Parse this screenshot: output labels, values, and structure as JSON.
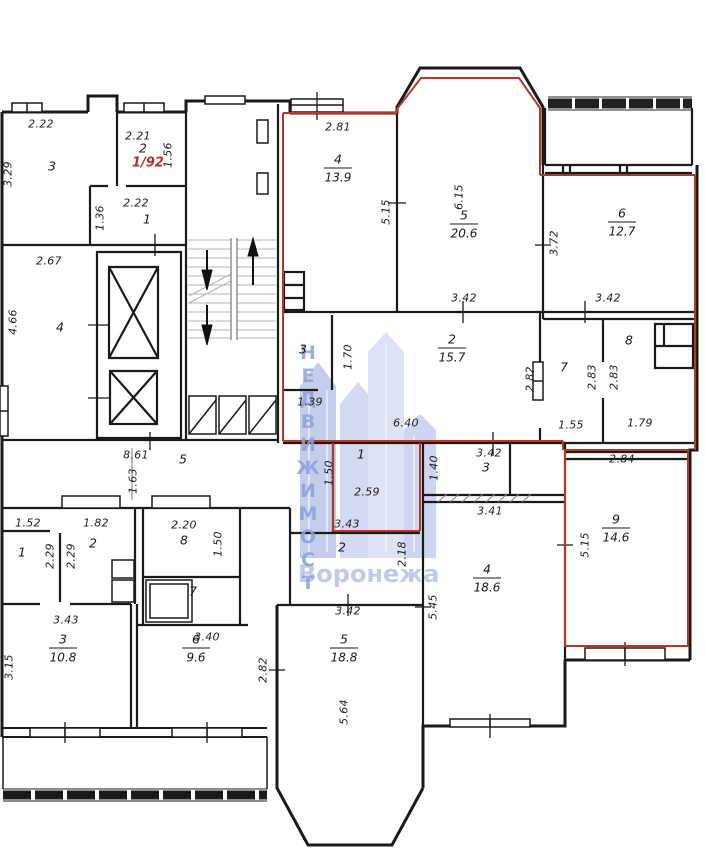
{
  "plan": {
    "flat_label": {
      "text": "1/92",
      "x": 148,
      "y": 163,
      "color": "#b03227"
    },
    "watermark": {
      "vertical_text": "НЕДВИЖИМОСТ",
      "bottom_text": "Воронежа",
      "color": "#8fa0d8"
    },
    "colors": {
      "wall": "#1a1a1a",
      "highlight": "#b03a27",
      "stairs": "#b5b5b5"
    },
    "room_labels": [
      {
        "num": "4",
        "area": "13.9",
        "x": 338,
        "y": 168
      },
      {
        "num": "5",
        "area": "20.6",
        "x": 464,
        "y": 224
      },
      {
        "num": "6",
        "area": "12.7",
        "x": 622,
        "y": 222
      },
      {
        "num": "2",
        "area": "15.7",
        "x": 452,
        "y": 348
      },
      {
        "num": "9",
        "area": "14.6",
        "x": 616,
        "y": 528
      },
      {
        "num": "4",
        "area": "18.6",
        "x": 487,
        "y": 578
      },
      {
        "num": "5",
        "area": "18.8",
        "x": 344,
        "y": 648
      },
      {
        "num": "3",
        "area": "10.8",
        "x": 63,
        "y": 648
      },
      {
        "num": "6",
        "area": "9.6",
        "x": 196,
        "y": 648
      }
    ],
    "room_numbers": [
      {
        "t": "3",
        "x": 52,
        "y": 166
      },
      {
        "t": "2",
        "x": 143,
        "y": 148
      },
      {
        "t": "1",
        "x": 147,
        "y": 219
      },
      {
        "t": "4",
        "x": 60,
        "y": 327
      },
      {
        "t": "3",
        "x": 303,
        "y": 349
      },
      {
        "t": "7",
        "x": 564,
        "y": 367
      },
      {
        "t": "8",
        "x": 629,
        "y": 340
      },
      {
        "t": "1",
        "x": 361,
        "y": 454
      },
      {
        "t": "3",
        "x": 486,
        "y": 467
      },
      {
        "t": "2",
        "x": 342,
        "y": 547
      },
      {
        "t": "1",
        "x": 22,
        "y": 552
      },
      {
        "t": "2",
        "x": 93,
        "y": 543
      },
      {
        "t": "8",
        "x": 184,
        "y": 540
      },
      {
        "t": "7",
        "x": 193,
        "y": 591
      },
      {
        "t": "5",
        "x": 183,
        "y": 459
      }
    ],
    "dimensions": [
      {
        "t": "2.22",
        "x": 41,
        "y": 124,
        "r": 0
      },
      {
        "t": "2.21",
        "x": 138,
        "y": 136,
        "r": 0
      },
      {
        "t": "2.22",
        "x": 136,
        "y": 203,
        "r": 0
      },
      {
        "t": "2.67",
        "x": 49,
        "y": 261,
        "r": 0
      },
      {
        "t": "2.81",
        "x": 338,
        "y": 127,
        "r": 0
      },
      {
        "t": "3.42",
        "x": 464,
        "y": 298,
        "r": 0
      },
      {
        "t": "3.42",
        "x": 608,
        "y": 298,
        "r": 0
      },
      {
        "t": "1.39",
        "x": 310,
        "y": 402,
        "r": 0
      },
      {
        "t": "6.40",
        "x": 406,
        "y": 423,
        "r": 0
      },
      {
        "t": "1.55",
        "x": 571,
        "y": 425,
        "r": 0
      },
      {
        "t": "1.79",
        "x": 640,
        "y": 423,
        "r": 0
      },
      {
        "t": "2.84",
        "x": 622,
        "y": 459,
        "r": 0
      },
      {
        "t": "3.42",
        "x": 489,
        "y": 453,
        "r": 0
      },
      {
        "t": "3.41",
        "x": 490,
        "y": 511,
        "r": 0
      },
      {
        "t": "8.61",
        "x": 136,
        "y": 455,
        "r": 0
      },
      {
        "t": "1.52",
        "x": 28,
        "y": 523,
        "r": 0
      },
      {
        "t": "1.82",
        "x": 96,
        "y": 523,
        "r": 0
      },
      {
        "t": "2.20",
        "x": 184,
        "y": 525,
        "r": 0
      },
      {
        "t": "2.59",
        "x": 367,
        "y": 492,
        "r": 0
      },
      {
        "t": "3.43",
        "x": 347,
        "y": 524,
        "r": 0
      },
      {
        "t": "3.43",
        "x": 66,
        "y": 620,
        "r": 0
      },
      {
        "t": "3.40",
        "x": 207,
        "y": 637,
        "r": 0
      },
      {
        "t": "3.42",
        "x": 348,
        "y": 611,
        "r": 0
      },
      {
        "t": "3.29",
        "x": 8,
        "y": 174,
        "r": -90
      },
      {
        "t": "1.56",
        "x": 168,
        "y": 155,
        "r": -90
      },
      {
        "t": "1.36",
        "x": 100,
        "y": 218,
        "r": -90
      },
      {
        "t": "4.66",
        "x": 13,
        "y": 322,
        "r": -90
      },
      {
        "t": "5.15",
        "x": 386,
        "y": 212,
        "r": -90
      },
      {
        "t": "6.15",
        "x": 459,
        "y": 197,
        "r": -90
      },
      {
        "t": "3.72",
        "x": 554,
        "y": 243,
        "r": -90
      },
      {
        "t": "1.70",
        "x": 348,
        "y": 357,
        "r": -90
      },
      {
        "t": "2.82",
        "x": 530,
        "y": 379,
        "r": -90
      },
      {
        "t": "2.83",
        "x": 592,
        "y": 377,
        "r": -90
      },
      {
        "t": "2.83",
        "x": 614,
        "y": 377,
        "r": -90
      },
      {
        "t": "1.63",
        "x": 133,
        "y": 481,
        "r": -90
      },
      {
        "t": "2.29",
        "x": 50,
        "y": 556,
        "r": -90
      },
      {
        "t": "2.29",
        "x": 71,
        "y": 556,
        "r": -90
      },
      {
        "t": "1.50",
        "x": 218,
        "y": 544,
        "r": -90
      },
      {
        "t": "1.50",
        "x": 329,
        "y": 473,
        "r": -90
      },
      {
        "t": "1.40",
        "x": 434,
        "y": 468,
        "r": -90
      },
      {
        "t": "2.18",
        "x": 402,
        "y": 554,
        "r": -90
      },
      {
        "t": "5.15",
        "x": 585,
        "y": 545,
        "r": -90
      },
      {
        "t": "5.45",
        "x": 433,
        "y": 607,
        "r": -90
      },
      {
        "t": "5.64",
        "x": 344,
        "y": 712,
        "r": -90
      },
      {
        "t": "2.82",
        "x": 263,
        "y": 670,
        "r": -90
      },
      {
        "t": "3.15",
        "x": 9,
        "y": 667,
        "r": -90
      }
    ]
  }
}
